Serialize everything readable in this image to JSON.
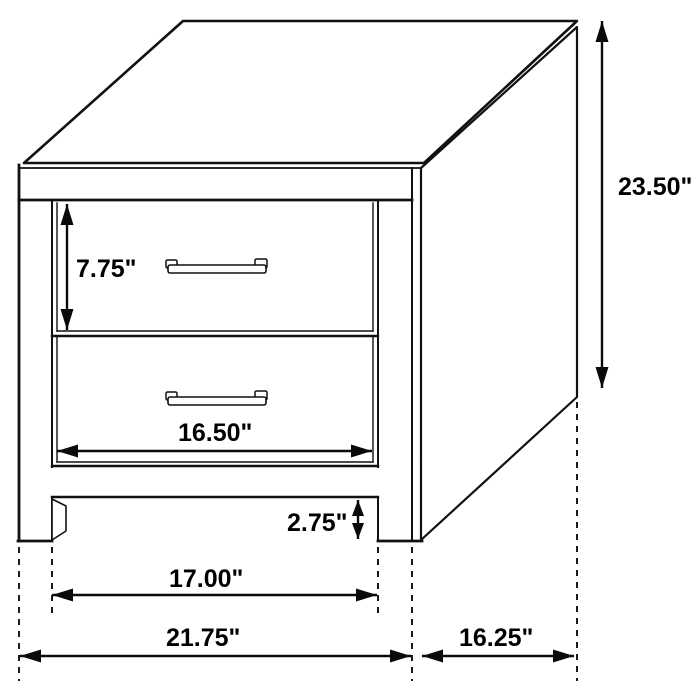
{
  "diagram": {
    "kind": "furniture-dimension-diagram",
    "subject": "two-drawer nightstand isometric line drawing",
    "unit": "inches",
    "background_color": "#ffffff",
    "line_color": "#111111",
    "text_color": "#000000",
    "labels": {
      "overall_height": "23.50\"",
      "top_drawer_height": "7.75\"",
      "drawer_width": "16.50\"",
      "base_clearance": "2.75\"",
      "leg_spacing": "17.00\"",
      "overall_width": "21.75\"",
      "side_depth": "16.25\""
    }
  }
}
